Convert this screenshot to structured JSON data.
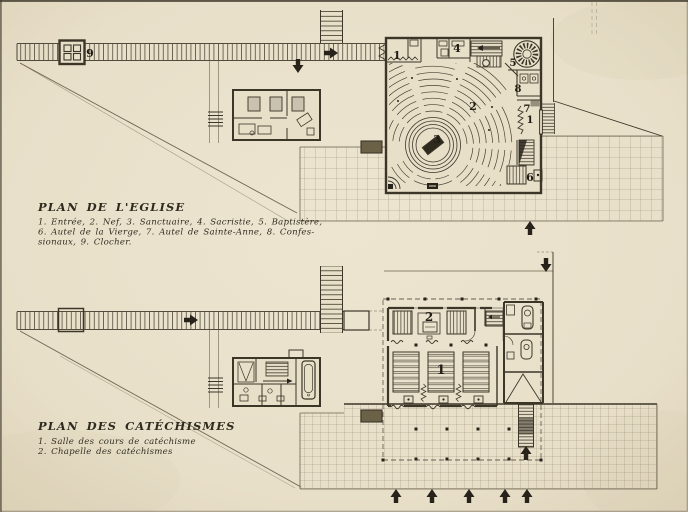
{
  "palette": {
    "paper": "#e8dfc9",
    "ink": "#3c3628",
    "ink_dark": "#27221a",
    "faint_line": "#6d6450"
  },
  "eglise": {
    "title": "PLAN DE L'EGLISE",
    "legend": [
      "1. Entrée, 2. Nef, 3. Sanctuaire, 4. Sacristie, 5. Baptistère,",
      "6. Autel de la Vierge, 7. Autel de Sainte-Anne, 8. Confes-",
      "sionaux, 9. Clocher."
    ],
    "labels": {
      "entree": "1",
      "entree_laterale": "1",
      "nef": "2",
      "sanctuaire": "3",
      "sacristie": "4",
      "baptistere": "5",
      "autel_vierge": "6",
      "autel_sainte_anne": "7",
      "confessionaux": "8",
      "clocher": "9"
    }
  },
  "catechismes": {
    "title": "PLAN DES CATÉCHISMES",
    "legend": [
      "1. Salle des cours de catéchisme",
      "2. Chapelle des catéchismes"
    ],
    "labels": {
      "salle": "1",
      "chapelle": "2"
    }
  }
}
